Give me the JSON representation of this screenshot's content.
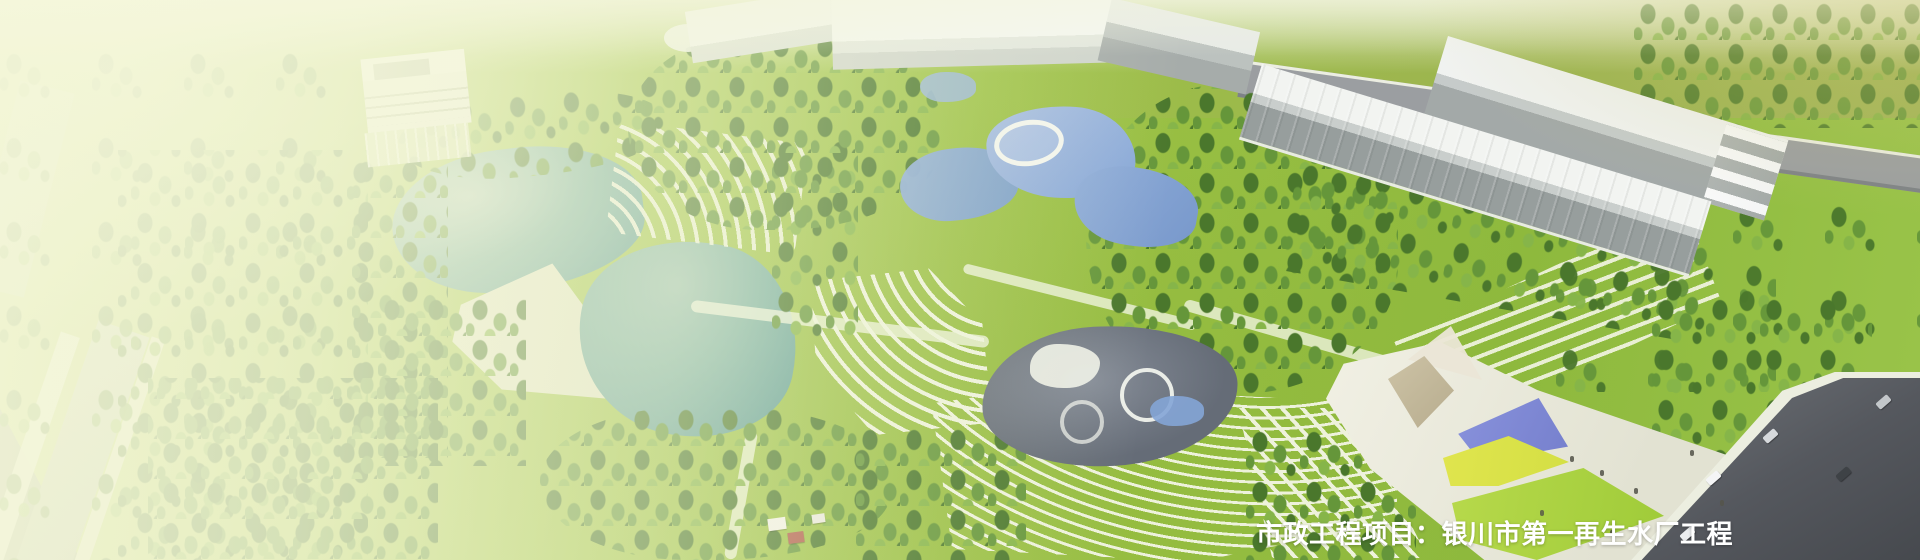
{
  "banner": {
    "caption": "市政工程项目：银川市第一再生水厂工程"
  },
  "colors": {
    "lawn": "#9cc145",
    "lawn_light": "#b7d35f",
    "tree_dark": "#4a772c",
    "tree_mid": "#65963a",
    "tree_lite": "#86b549",
    "lake": "#7fb3a4",
    "lake_deep": "#5f9d96",
    "plaza_sand": "#dfe2c4",
    "path_white": "#eef2dc",
    "bldg_white": "#f2f4f0",
    "bldg_dark": "#979e9d",
    "back_road": "#9b9ea1",
    "road_dark": "#55585e",
    "canal": "#aab59e",
    "field_olive": "#9aa38b",
    "playground": "#656c77",
    "pool_blue": "#84a5d6",
    "pav_blue": "#7680cd",
    "pav_yellow": "#d4df44",
    "canopy_tan": "#b7ac8e",
    "caption": "#ffffff"
  }
}
